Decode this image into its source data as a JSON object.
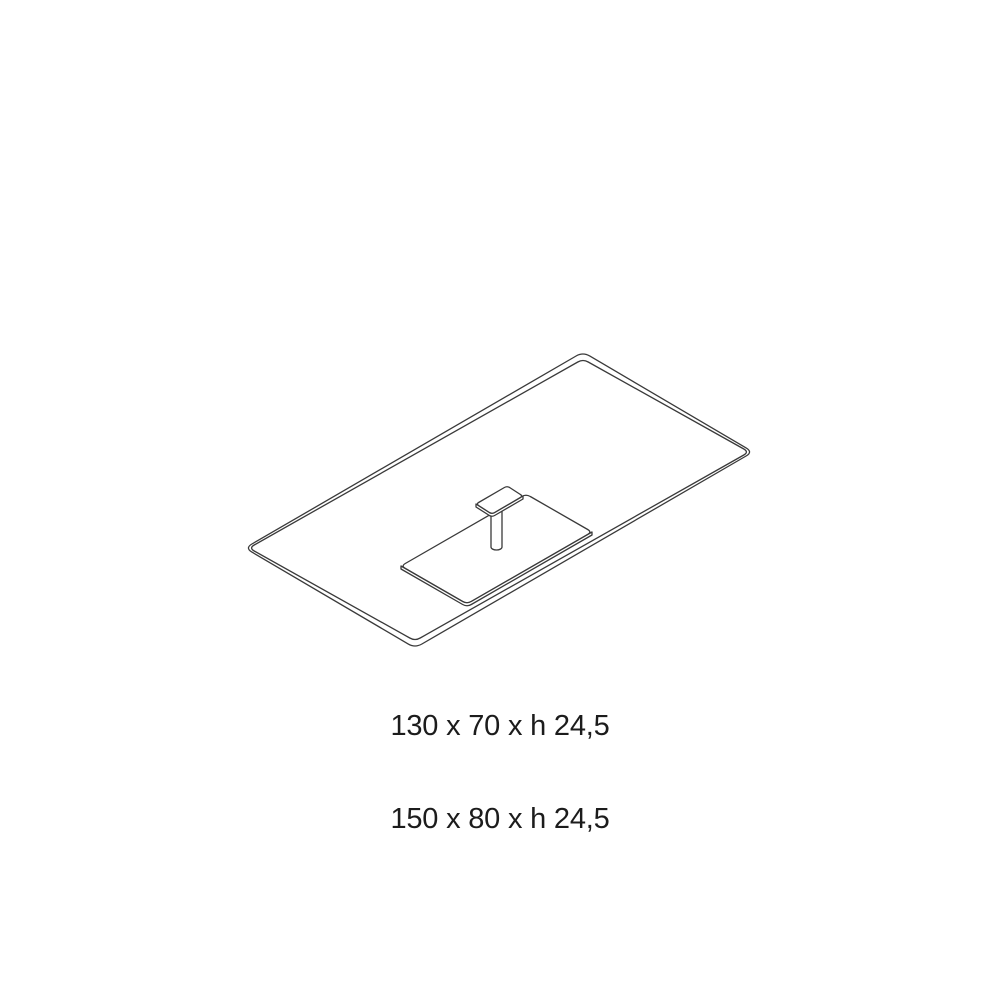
{
  "colors": {
    "line": "#3a3a3a",
    "text": "#1c1c1c",
    "background": "#ffffff"
  },
  "drawing": {
    "description": "Isometric line drawing of a rectangular glass-top low table with a central pedestal: flat base plate, short cylindrical column and small top mounting plate",
    "parts": [
      "table-top-outer-edge",
      "table-top-inner-edge",
      "base-plate-face",
      "base-plate-thickness",
      "pedestal-column",
      "top-plate-thickness",
      "top-plate-face"
    ]
  },
  "dimensions": {
    "lines": [
      "130 x 70 x h 24,5",
      "150 x 80 x h 24,5"
    ]
  }
}
